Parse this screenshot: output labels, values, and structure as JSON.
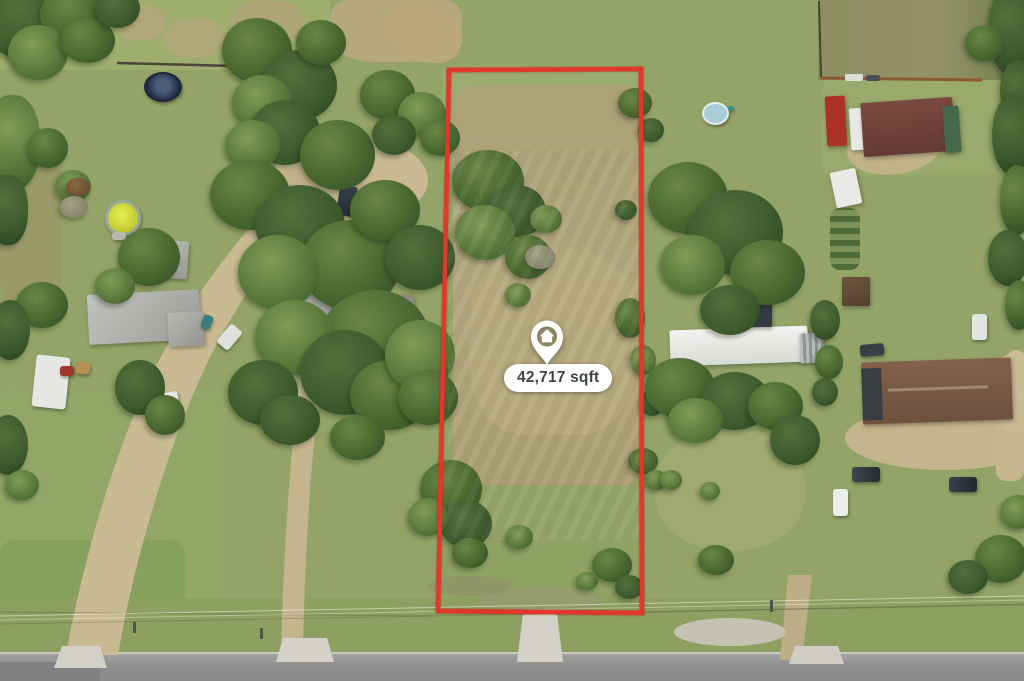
{
  "image": {
    "type": "aerial-property-listing-photo",
    "overlay": {
      "area_label": "42,717 sqft",
      "pin_icon": "home-location-pin-icon",
      "boundary_color": "#e2372a",
      "label_background": "#ffffff",
      "label_text_color": "#3e434a",
      "pin_color": "#ffffff"
    },
    "scene": {
      "description": "Top-down drone view of a rectangular vacant grass parcel outlined in red, with a home location pin and square-footage label; surrounded by neighboring houses, sheds, trailers, tree clusters, dirt driveways and a paved road along the bottom edge",
      "features": [
        "grass-fields",
        "dry-grass-patches",
        "tree-clusters",
        "red-parcel-boundary",
        "gray-roof-house",
        "brown-roof-house",
        "white-barn",
        "mobile-home",
        "rv-trailer",
        "sheds",
        "vehicles",
        "trampoline",
        "above-ground-pools",
        "dirt-driveways",
        "concrete-aprons",
        "paved-road",
        "utility-lines",
        "fence-lines"
      ]
    }
  }
}
